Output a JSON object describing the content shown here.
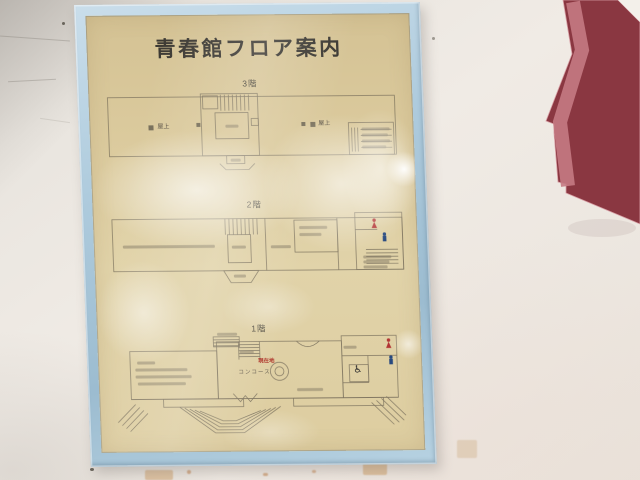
{
  "sign": {
    "title": "青春館フロア案内",
    "floor3": {
      "label": "3階",
      "rooftop_left": "屋上",
      "rooftop_right": "屋上"
    },
    "floor2": {
      "label": "2階"
    },
    "floor1": {
      "label": "1階",
      "you_are_here": "現在地",
      "concourse": "コンコース",
      "wheelchair_symbol": "♿"
    }
  },
  "colors": {
    "frame_blue": "#a9c8dd",
    "paper_tan": "#dbcb9f",
    "plan_line": "#6e6554",
    "you_are_here_red": "#b03a2e",
    "female_icon_red": "#b23434",
    "male_icon_blue": "#27497f",
    "staircase_dark_red": "#8a3741",
    "staircase_light_red": "#c47a83"
  }
}
